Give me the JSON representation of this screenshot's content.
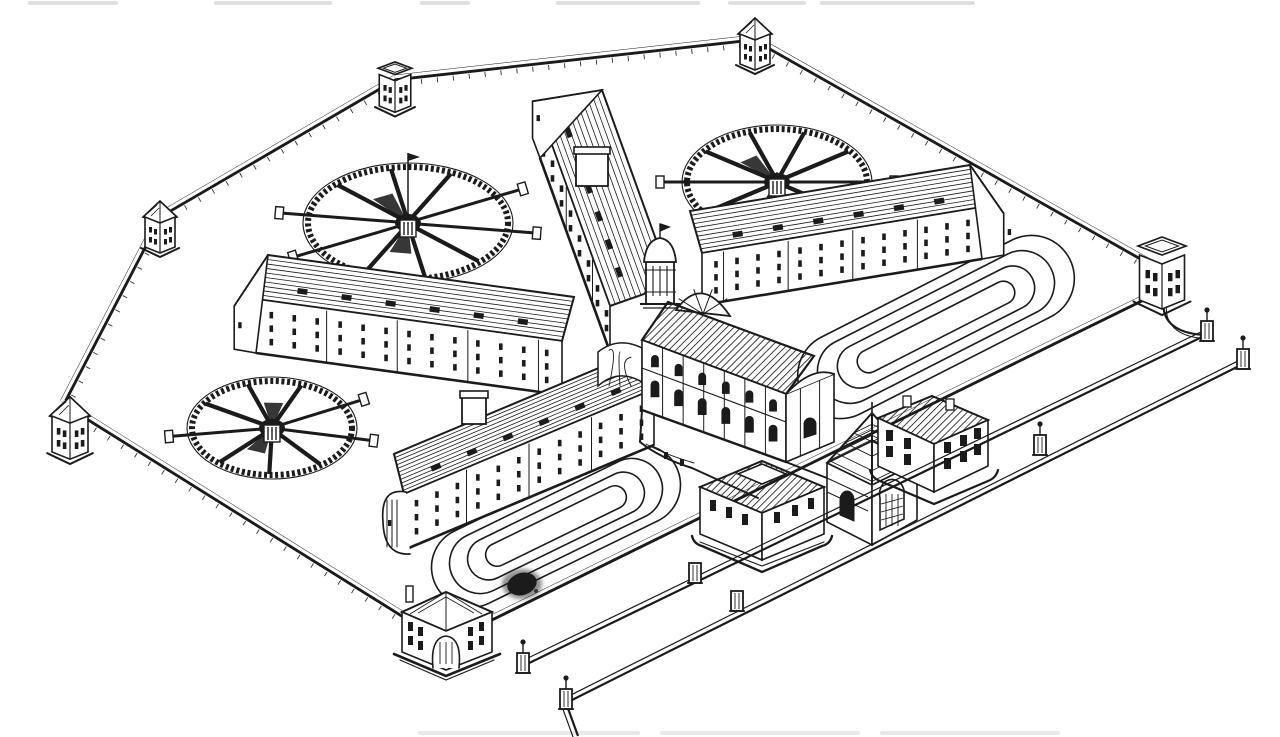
{
  "meta": {
    "title": "Black-ink bird's-eye engraving of a Pentonville-type radial prison: four cell-block wings around a central hall, three wheel-shaped airing yards, two oval exercise tracks, gate lodges, and a walled perimeter with corner towers",
    "style": "line engraving, black ink on white paper",
    "visible_text": ""
  },
  "colors": {
    "ink": "#1b1b1b",
    "paper": "#ffffff",
    "smudge": "#d9d9d9"
  },
  "perimeter": {
    "rear_wall_points": [
      [
        63,
        402
      ],
      [
        160,
        215
      ],
      [
        395,
        78
      ],
      [
        754,
        38
      ],
      [
        1160,
        268
      ]
    ],
    "left_wall": [
      [
        63,
        402
      ],
      [
        445,
        641
      ]
    ],
    "front_wall": [
      [
        445,
        641
      ],
      [
        1160,
        290
      ]
    ],
    "gate_curve": "M1164,296 Q1158,332 1204,335",
    "towers": [
      {
        "name": "left-upper-corner-tower",
        "x": 160,
        "y": 247,
        "s": 1.0,
        "type": "pyramid"
      },
      {
        "name": "top-corner-tower",
        "x": 395,
        "y": 106,
        "s": 1.05,
        "type": "parapet"
      },
      {
        "name": "top-right-corner-tower",
        "x": 755,
        "y": 64,
        "s": 1.0,
        "type": "pyramid"
      },
      {
        "name": "left-corner-tower",
        "x": 70,
        "y": 452,
        "s": 1.2,
        "type": "pyramid"
      },
      {
        "name": "right-corner-tower",
        "x": 1162,
        "y": 300,
        "s": 1.5,
        "type": "parapet"
      }
    ]
  },
  "wings": [
    {
      "name": "rear-centre-cell-block",
      "a": [
        540,
        112
      ],
      "b": [
        610,
        306
      ],
      "h": 46,
      "roof": [
        62,
        -22
      ],
      "cols": 8,
      "rows": 2,
      "roofLines": 12,
      "dormers": 6,
      "chimney": [
        576,
        152,
        32,
        34
      ],
      "end": "gable"
    },
    {
      "name": "rear-right-cell-block",
      "a": [
        982,
        207
      ],
      "b": [
        702,
        253
      ],
      "h": 52,
      "roof": [
        -12,
        -42
      ],
      "cols": 13,
      "rows": 3,
      "roofLines": 10,
      "dormers": 6,
      "end": "gable"
    },
    {
      "name": "rear-left-cell-block",
      "a": [
        256,
        299
      ],
      "b": [
        562,
        341
      ],
      "h": 54,
      "roof": [
        12,
        -44
      ],
      "cols": 13,
      "rows": 3,
      "roofLines": 10,
      "dormers": 6,
      "end": "gable"
    },
    {
      "name": "front-left-cell-block",
      "a": [
        404,
        494
      ],
      "b": [
        654,
        389
      ],
      "h": 56,
      "roof": [
        -10,
        -40
      ],
      "cols": 12,
      "rows": 3,
      "roofLines": 11,
      "dormers": 6,
      "chimney": [
        462,
        396,
        24,
        28
      ],
      "end": "round"
    }
  ],
  "airing_yards": [
    {
      "name": "airing-yard-north-west",
      "cx": 408,
      "cy": 223,
      "rx": 100,
      "ry": 56,
      "spokes": 10,
      "rot": 8,
      "mast": true
    },
    {
      "name": "airing-yard-north-east",
      "cx": 777,
      "cy": 182,
      "rx": 90,
      "ry": 53,
      "spokes": 10,
      "rot": 0,
      "mast": false
    },
    {
      "name": "airing-yard-west",
      "cx": 272,
      "cy": 428,
      "rx": 80,
      "ry": 47,
      "spokes": 9,
      "rot": 12,
      "mast": false
    }
  ],
  "exercise_ovals": [
    {
      "name": "east-exercise-track",
      "cx": 936,
      "cy": 327,
      "angle": -27,
      "w": 300,
      "h": 86,
      "laps": 4,
      "sw": 42,
      "sh": 21
    },
    {
      "name": "front-exercise-track",
      "cx": 556,
      "cy": 526,
      "angle": -26,
      "w": 268,
      "h": 80,
      "laps": 4,
      "sw": 38,
      "sh": 19
    }
  ],
  "roads": [
    {
      "name": "outer-boundary-road",
      "from": [
        1204,
        336
      ],
      "to": [
        523,
        666
      ],
      "gap": 5
    },
    {
      "name": "outermost-road",
      "from": [
        1243,
        364
      ],
      "to": [
        566,
        703
      ],
      "gap": 5
    },
    {
      "name": "entrance-road-stub",
      "from": [
        566,
        703
      ],
      "to": [
        578,
        736
      ],
      "gap": 5
    }
  ],
  "gate_piers": [
    {
      "name": "east-gate-pier",
      "x": 1207,
      "y": 330,
      "ball": true
    },
    {
      "name": "east-outer-gate-pier",
      "x": 1243,
      "y": 358,
      "ball": true
    },
    {
      "name": "mid-road-pier",
      "x": 1040,
      "y": 444,
      "ball": true
    },
    {
      "name": "south-gate-pier",
      "x": 523,
      "y": 662,
      "ball": true
    },
    {
      "name": "south-outer-gate-pier",
      "x": 566,
      "y": 698,
      "ball": true
    },
    {
      "name": "forecourt-block-west",
      "x": 695,
      "y": 572,
      "ball": false
    },
    {
      "name": "forecourt-block-east",
      "x": 737,
      "y": 600,
      "ball": false
    }
  ],
  "ink_blot": {
    "x": 522,
    "y": 584,
    "rx": 15,
    "ry": 11
  },
  "smudges": {
    "top": [
      [
        28,
        118
      ],
      [
        214,
        332
      ],
      [
        420,
        470
      ],
      [
        556,
        700
      ],
      [
        728,
        806
      ],
      [
        820,
        975
      ]
    ],
    "bottom": [
      [
        418,
        640
      ],
      [
        660,
        860
      ],
      [
        880,
        1060
      ]
    ]
  }
}
